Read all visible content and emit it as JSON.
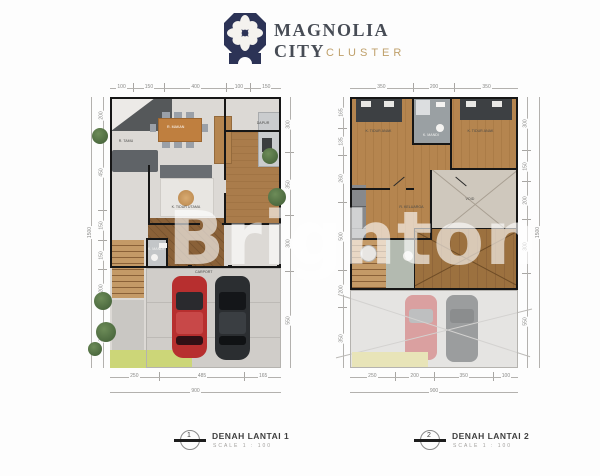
{
  "header": {
    "title_line1": "MAGNOLIA",
    "title_line2": "CITY",
    "subtitle": "CLUSTER",
    "brand_navy": "#2c3356",
    "brand_gold": "#bfa06a"
  },
  "watermark": "Brighton",
  "plan1": {
    "rooms": {
      "living": "R. TAMU",
      "dining": "R. MAKAN",
      "kitchen": "DAPUR",
      "bedroom": "K. TIDUR UTAMA",
      "bath": "K. MANDI",
      "carport": "CARPORT"
    },
    "dims": {
      "top": [
        "100",
        "150",
        "400",
        "100",
        "150"
      ],
      "left_total": "1500",
      "left": [
        "200",
        "450",
        "150",
        "150",
        "200",
        "350"
      ],
      "right": [
        "300",
        "350",
        "300",
        "550"
      ],
      "bottom": [
        "250",
        "485",
        "165"
      ],
      "bottom_total": "900"
    }
  },
  "plan2": {
    "rooms": {
      "bed1": "K. TIDUR ANAK",
      "bed2": "K. TIDUR ANAK",
      "bath": "K. MANDI",
      "hall": "R. KELUARGA",
      "void": "VOID"
    },
    "dims": {
      "top": [
        "350",
        "200",
        "350"
      ],
      "left": [
        "165",
        "135",
        "260",
        "500",
        "200",
        "350"
      ],
      "right": [
        "300",
        "150",
        "200",
        "300",
        "550"
      ],
      "right_total": "1500",
      "bottom": [
        "250",
        "200",
        "350",
        "100"
      ],
      "bottom_total": "900"
    }
  },
  "footer": {
    "item1": {
      "num": "1",
      "label": "DENAH LANTAI 1",
      "scale": "SCALE    1 : 100"
    },
    "item2": {
      "num": "2",
      "label": "DENAH LANTAI 2",
      "scale": "SCALE    1 : 100"
    }
  }
}
